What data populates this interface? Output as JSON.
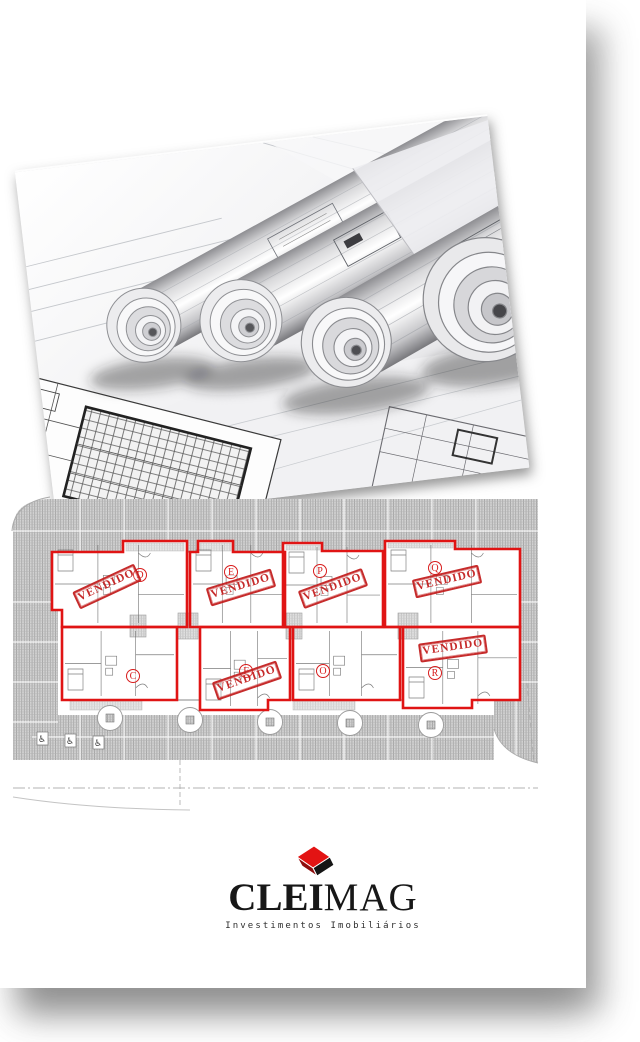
{
  "site_plan": {
    "stamp_label": "VENDIDO",
    "outline_color": "#e01414",
    "stamp_color": "#c32020",
    "units": [
      {
        "letter": "D",
        "sold": true,
        "bbox": [
          42,
          54,
          135,
          86
        ],
        "outline": "M42,65 H113 V54 H177 V140 H52 V123 H42 Z",
        "letter_pos": {
          "x": 130,
          "y": 88
        },
        "stamp": {
          "x": 97,
          "y": 100,
          "rot": -25
        }
      },
      {
        "letter": "E",
        "sold": true,
        "bbox": [
          180,
          54,
          95,
          86
        ],
        "outline": "M180,65 H188 V54 H223 V65 H275 V140 H180 Z",
        "letter_pos": {
          "x": 221,
          "y": 85
        },
        "stamp": {
          "x": 231,
          "y": 101,
          "rot": -17
        }
      },
      {
        "letter": "P",
        "sold": true,
        "bbox": [
          273,
          56,
          100,
          84
        ],
        "outline": "M273,56 H312 V64 H373 V140 H273 Z",
        "letter_pos": {
          "x": 310,
          "y": 84
        },
        "stamp": {
          "x": 323,
          "y": 102,
          "rot": -20
        }
      },
      {
        "letter": "Q",
        "sold": true,
        "bbox": [
          375,
          54,
          135,
          86
        ],
        "outline": "M375,54 H445 V62 H510 V140 H375 Z",
        "letter_pos": {
          "x": 425,
          "y": 81
        },
        "stamp": {
          "x": 437,
          "y": 95,
          "rot": -13
        }
      },
      {
        "letter": "C",
        "sold": false,
        "bbox": [
          52,
          140,
          115,
          73
        ],
        "outline": "M52,140 H167 V213 H52 Z",
        "letter_pos": {
          "x": 123,
          "y": 189
        },
        "stamp": null
      },
      {
        "letter": "F",
        "sold": true,
        "bbox": [
          190,
          140,
          90,
          83
        ],
        "outline": "M190,140 H280 V213 H258 V223 H190 Z",
        "letter_pos": {
          "x": 236,
          "y": 184
        },
        "stamp": {
          "x": 237,
          "y": 194,
          "rot": -19
        }
      },
      {
        "letter": "O",
        "sold": false,
        "bbox": [
          283,
          140,
          107,
          73
        ],
        "outline": "M283,140 H390 V213 H283 Z",
        "letter_pos": {
          "x": 313,
          "y": 184
        },
        "stamp": null
      },
      {
        "letter": "R",
        "sold": true,
        "bbox": [
          393,
          140,
          117,
          81
        ],
        "outline": "M393,140 H510 V213 H462 V221 H393 Z",
        "letter_pos": {
          "x": 425,
          "y": 186
        },
        "stamp": {
          "x": 443,
          "y": 162,
          "rot": -8
        }
      }
    ]
  },
  "logo": {
    "brand_bold": "CLEI",
    "brand_light": "MAG",
    "tagline": "Investimentos Imobiliários",
    "cube_red": "#e31414"
  }
}
